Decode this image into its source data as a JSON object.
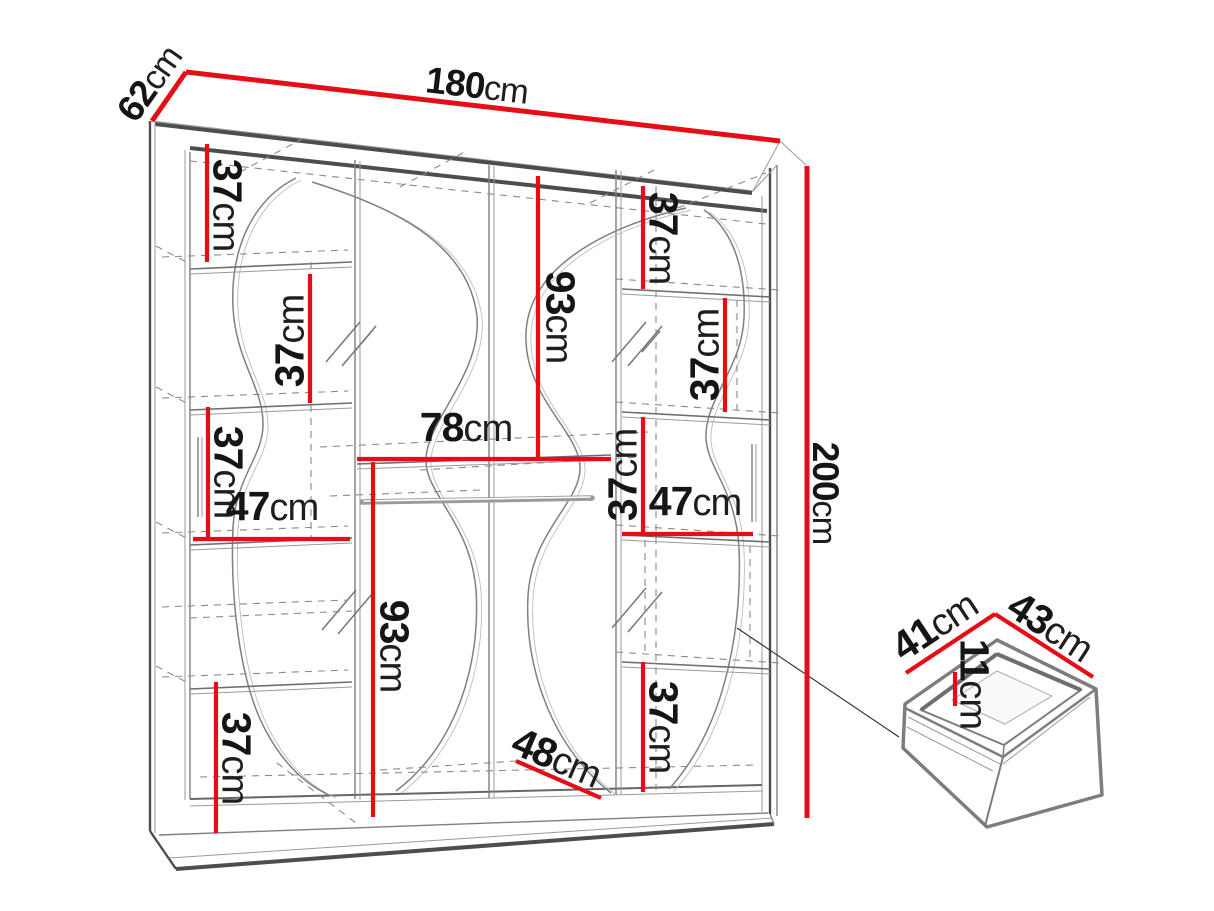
{
  "diagram": {
    "type": "wardrobe-dimension-drawing",
    "unit": "cm",
    "accent_color": "#e60e16",
    "line_color": "#4d4d4d",
    "background": "#ffffff"
  },
  "labels": {
    "width": {
      "num": "180",
      "unit": "cm"
    },
    "depth": {
      "num": "62",
      "unit": "cm"
    },
    "height": {
      "num": "200",
      "unit": "cm"
    },
    "left_top_gap": {
      "num": "37",
      "unit": "cm"
    },
    "left_mid_gap": {
      "num": "37",
      "unit": "cm"
    },
    "left_lower_gap": {
      "num": "37",
      "unit": "cm"
    },
    "left_shelf_width": {
      "num": "47",
      "unit": "cm"
    },
    "left_bottom_gap": {
      "num": "37",
      "unit": "cm"
    },
    "center_shelf_width": {
      "num": "78",
      "unit": "cm"
    },
    "center_upper_height": {
      "num": "93",
      "unit": "cm"
    },
    "center_lower_height": {
      "num": "93",
      "unit": "cm"
    },
    "bottom_depth": {
      "num": "48",
      "unit": "cm"
    },
    "right_top_gap": {
      "num": "37",
      "unit": "cm"
    },
    "right_upper_gap": {
      "num": "37",
      "unit": "cm"
    },
    "right_mid_gap": {
      "num": "37",
      "unit": "cm"
    },
    "right_shelf_width": {
      "num": "47",
      "unit": "cm"
    },
    "right_bottom_gap": {
      "num": "37",
      "unit": "cm"
    },
    "drawer_depth": {
      "num": "41",
      "unit": "cm"
    },
    "drawer_width": {
      "num": "43",
      "unit": "cm"
    },
    "drawer_height": {
      "num": "11",
      "unit": "cm"
    }
  }
}
